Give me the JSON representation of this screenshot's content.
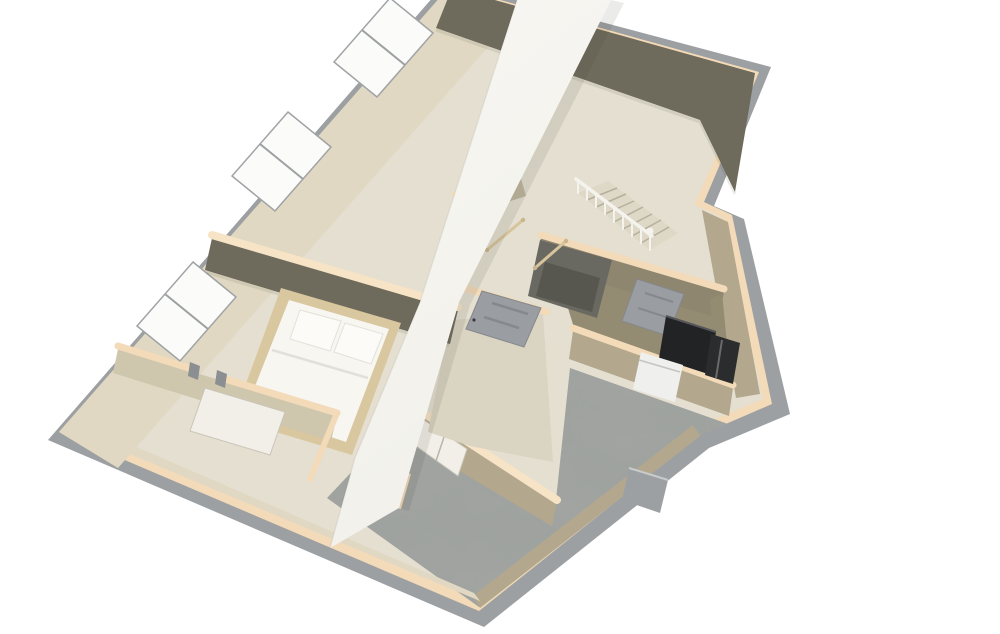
{
  "scene": {
    "type": "3D dollhouse floor-plan rendering",
    "view": "overhead perspective, plan rotated with north corner at top",
    "background": "#ffffff",
    "visible_text": ""
  },
  "palette": {
    "exterior_gray": "#9da0a2",
    "wall_cap_peach": "#f3dab8",
    "wall_cap_bright": "#f7e3c6",
    "wall_lit_beige": "#e0d8c2",
    "wall_shadow_olive": "#6f6b5c",
    "wall_shadow_brown": "#8f8670",
    "wall_tan": "#b3a88e",
    "wall_tan_dark": "#948b73",
    "carpet_cream": "#e6e1d2",
    "carpet_hall": "#dcd5c3",
    "concrete_gray": "#9ea19e",
    "strip_white": "#f6f5f1",
    "bed_frame_tan": "#d9c7a0",
    "bedding_white": "#f7f6f1",
    "pillow_white": "#fcfbf8",
    "pillow_edge": "#e3e1d8",
    "window_white": "#fbfbfa",
    "frame_gray": "#a0a3a5",
    "door_gray": "#9a9da1",
    "door_panel_gray": "#85888c",
    "door_white": "#f2efe9",
    "appliance_black": "#222324",
    "appliance_steel": "#2b2c2d",
    "washer_white": "#efefed",
    "stair_tread": "#ded8c7",
    "tread_gap": "#b6af9d",
    "baluster_white": "#f4f3ee",
    "rail_wood": "#d8c49c",
    "shaft_dark": "#696962",
    "shaft_dark2": "#57574f",
    "shadow_soft": "rgba(60,60,50,0.10)"
  },
  "rooms": [
    {
      "id": "bonus_room",
      "label": "large carpeted room, top, windows on upper-left wall"
    },
    {
      "id": "bedroom",
      "label": "bedroom with double bed, left middle"
    },
    {
      "id": "closets",
      "label": "closet strip along lower-left wall"
    },
    {
      "id": "hallway",
      "label": "hall with gray six-panel door, center"
    },
    {
      "id": "stair_landing",
      "label": "landing with wood handrails around stairwell"
    },
    {
      "id": "utility_room",
      "label": "utility room with furnace, water heater, washer"
    },
    {
      "id": "garage",
      "label": "unfinished concrete-floor area, bottom"
    }
  ],
  "objects": [
    "double bed with white bedding and two pillows",
    "staircase with white balusters, handrail and newel post",
    "two wood guard rails at stair landing",
    "three white windows on exterior wall",
    "gray six-panel hall door",
    "gray utility-room door",
    "white double closet doors facing garage",
    "open white closet door in bedroom",
    "black furnace, dark water heater, white washer",
    "white ceiling/floor cut band crossing the plan diagonally"
  ]
}
